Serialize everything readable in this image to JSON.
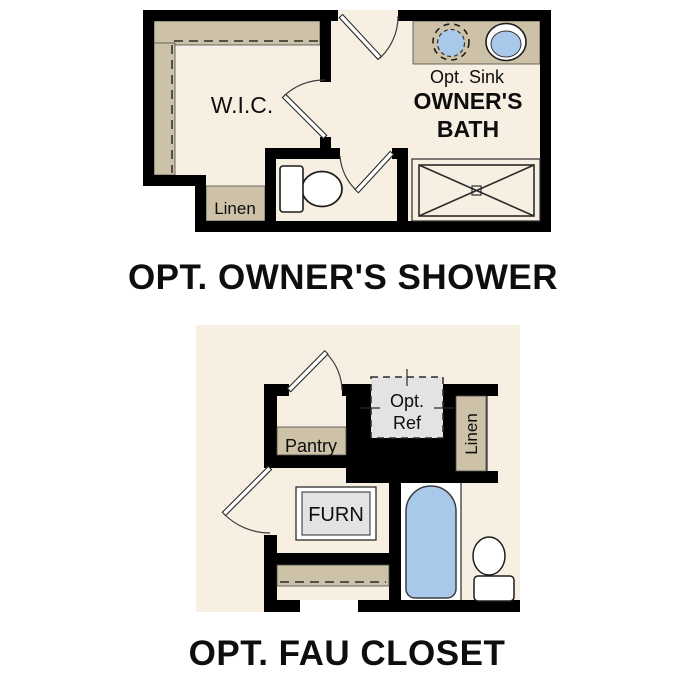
{
  "page": {
    "background": "#ffffff"
  },
  "colors": {
    "page": "#ffffff",
    "wall": "#000000",
    "floor": "#f7efe2",
    "casework": "#cdc1a8",
    "fixture_blue": "#a9c9eb",
    "equipment_gray": "#e3e3e3",
    "line": "#2b2b2b"
  },
  "top_plan": {
    "title": "OPT. OWNER'S SHOWER",
    "rooms": {
      "wic": "W.I.C.",
      "linen": "Linen",
      "bath_line1": "OWNER'S",
      "bath_line2": "BATH",
      "opt_sink": "Opt. Sink"
    }
  },
  "bottom_plan": {
    "title": "OPT. FAU CLOSET",
    "rooms": {
      "pantry": "Pantry",
      "opt_ref_line1": "Opt.",
      "opt_ref_line2": "Ref",
      "linen": "Linen",
      "furn": "FURN"
    }
  }
}
